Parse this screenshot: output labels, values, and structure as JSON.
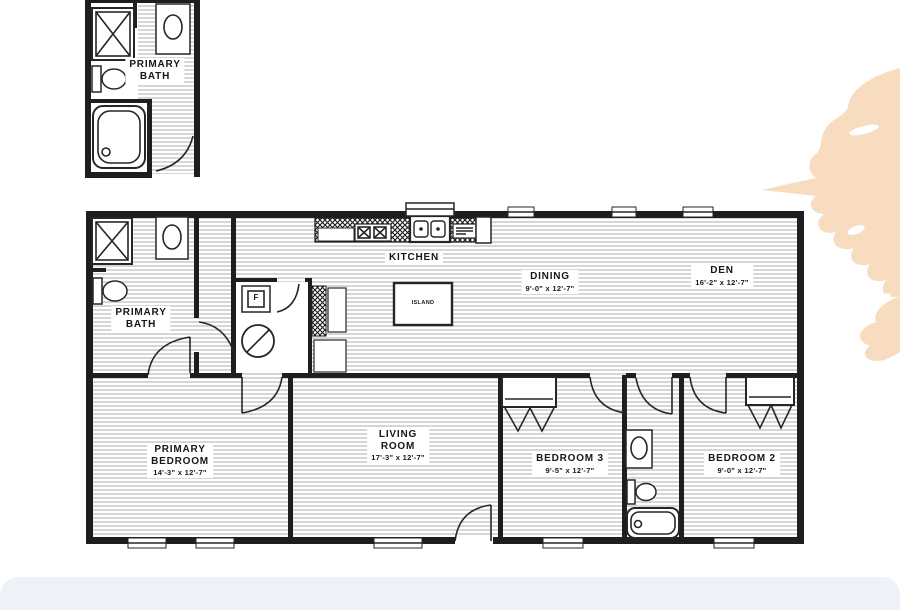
{
  "floor_plan": {
    "inset_bath": {
      "name": "PRIMARY\nBATH"
    },
    "rooms": {
      "primary_bath": {
        "name": "PRIMARY\nBATH",
        "dims": ""
      },
      "kitchen": {
        "name": "KITCHEN",
        "dims": ""
      },
      "island": {
        "name": "ISLAND"
      },
      "dining": {
        "name": "DINING",
        "dims": "9'-0\" x 12'-7\""
      },
      "den": {
        "name": "DEN",
        "dims": "16'-2\" x 12'-7\""
      },
      "primary_bedroom": {
        "name": "PRIMARY\nBEDROOM",
        "dims": "14'-3\" x 12'-7\""
      },
      "living_room": {
        "name": "LIVING\nROOM",
        "dims": "17'-3\" x 12'-7\""
      },
      "bedroom_3": {
        "name": "BEDROOM 3",
        "dims": "9'-5\" x 12'-7\""
      },
      "bedroom_2": {
        "name": "BEDROOM 2",
        "dims": "9'-0\" x 12'-7\""
      }
    },
    "fixture_labels": {
      "furnace": "F"
    },
    "colors": {
      "wall": "#1e1e20",
      "hatch": "#b5b5b7",
      "accent_blob": "#f8dcc0",
      "bottom_band": "#edf2f8"
    }
  }
}
